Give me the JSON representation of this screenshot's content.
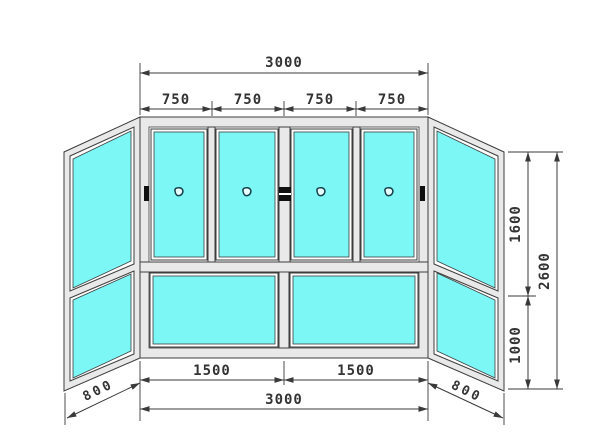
{
  "drawing": {
    "dims": {
      "top_total": "3000",
      "top_segments": [
        "750",
        "750",
        "750",
        "750"
      ],
      "bottom_segments": [
        "1500",
        "1500"
      ],
      "bottom_total": "3000",
      "right_upper": "1600",
      "right_lower": "1000",
      "right_total": "2600",
      "left_return": "800",
      "right_return": "800"
    },
    "structure": {
      "front_upper_sashes": 4,
      "front_lower_panels": 2,
      "side_panels": 2,
      "sections_per_side_panel": 2,
      "handles": 4
    },
    "colors": {
      "glass": "#7df6f6",
      "frame_fill": "#e9e9e9",
      "frame_outline": "#3d3d3d",
      "dim": "#3a3a3a",
      "hardware": "#101010",
      "background": "#ffffff"
    }
  }
}
